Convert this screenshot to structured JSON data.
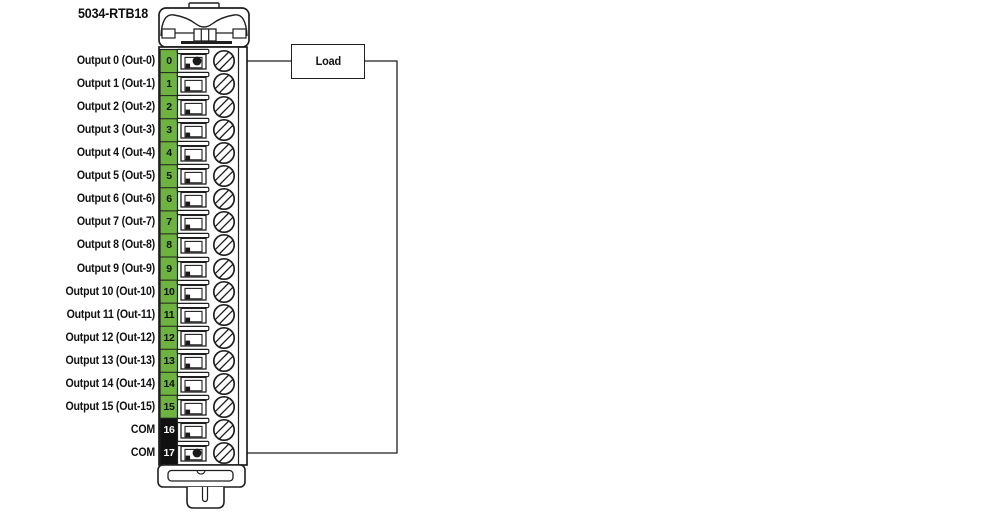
{
  "title": "5034-RTB18",
  "load": {
    "label": "Load"
  },
  "colors": {
    "green": "#6CB33F",
    "com_black": "#111111",
    "line": "#1F1F1F"
  },
  "rows": [
    {
      "num": "0",
      "label": "Output 0 (Out-0)",
      "wired": true
    },
    {
      "num": "1",
      "label": "Output 1 (Out-1)",
      "wired": false
    },
    {
      "num": "2",
      "label": "Output 2 (Out-2)",
      "wired": false
    },
    {
      "num": "3",
      "label": "Output 3 (Out-3)",
      "wired": false
    },
    {
      "num": "4",
      "label": "Output 4 (Out-4)",
      "wired": false
    },
    {
      "num": "5",
      "label": "Output 5 (Out-5)",
      "wired": false
    },
    {
      "num": "6",
      "label": "Output 6 (Out-6)",
      "wired": false
    },
    {
      "num": "7",
      "label": "Output 7 (Out-7)",
      "wired": false
    },
    {
      "num": "8",
      "label": "Output 8 (Out-8)",
      "wired": false
    },
    {
      "num": "9",
      "label": "Output 9 (Out-9)",
      "wired": false
    },
    {
      "num": "10",
      "label": "Output 10 (Out-10)",
      "wired": false
    },
    {
      "num": "11",
      "label": "Output 11 (Out-11)",
      "wired": false
    },
    {
      "num": "12",
      "label": "Output 12 (Out-12)",
      "wired": false
    },
    {
      "num": "13",
      "label": "Output 13 (Out-13)",
      "wired": false
    },
    {
      "num": "14",
      "label": "Output 14 (Out-14)",
      "wired": false
    },
    {
      "num": "15",
      "label": "Output 15 (Out-15)",
      "wired": false
    },
    {
      "num": "16",
      "label": "COM",
      "wired": false
    },
    {
      "num": "17",
      "label": "COM",
      "wired": true
    }
  ]
}
